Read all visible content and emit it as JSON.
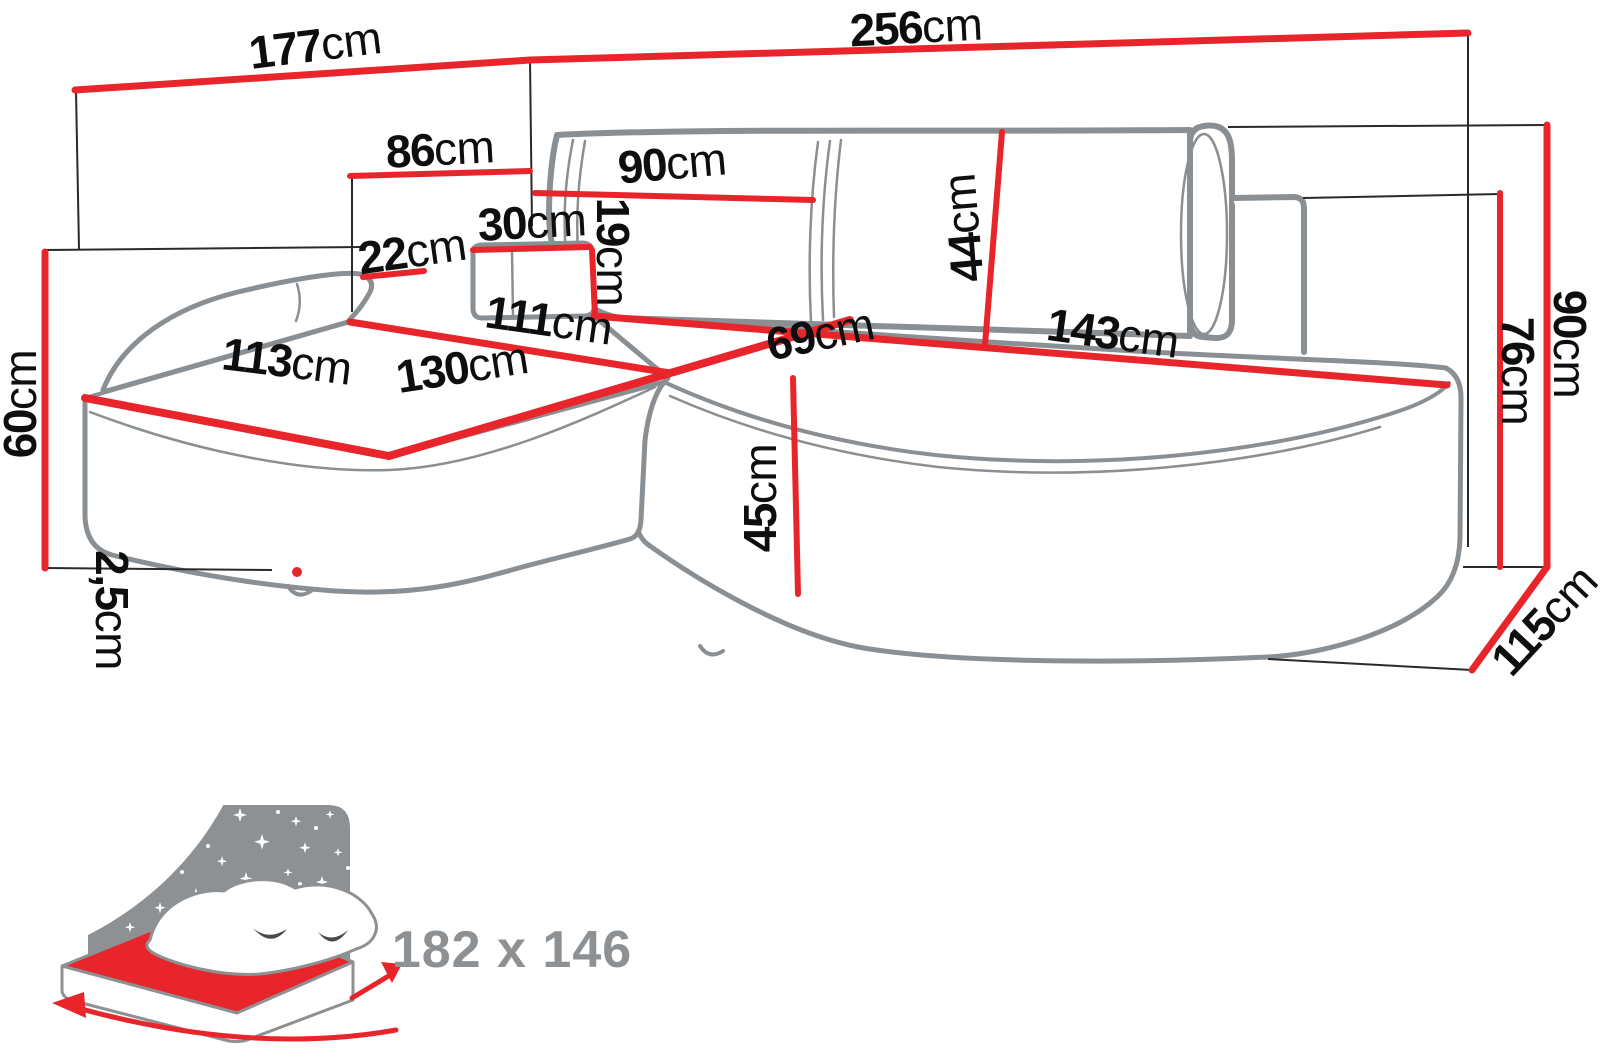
{
  "diagram_type": "corner-sofa-dimension-drawing",
  "unit": "cm",
  "dimensions": {
    "d177": {
      "v": "177",
      "u": "cm"
    },
    "d256": {
      "v": "256",
      "u": "cm"
    },
    "d86": {
      "v": "86",
      "u": "cm"
    },
    "d90top": {
      "v": "90",
      "u": "cm"
    },
    "d30": {
      "v": "30",
      "u": "cm"
    },
    "d19": {
      "v": "19",
      "u": "cm"
    },
    "d22": {
      "v": "22",
      "u": "cm"
    },
    "d44": {
      "v": "44",
      "u": "cm"
    },
    "d111": {
      "v": "111",
      "u": "cm"
    },
    "d113": {
      "v": "113",
      "u": "cm"
    },
    "d130": {
      "v": "130",
      "u": "cm"
    },
    "d69": {
      "v": "69",
      "u": "cm"
    },
    "d143": {
      "v": "143",
      "u": "cm"
    },
    "d60": {
      "v": "60",
      "u": "cm"
    },
    "d2_5": {
      "v": "2,5",
      "u": "cm"
    },
    "d45": {
      "v": "45",
      "u": "cm"
    },
    "d76": {
      "v": "76",
      "u": "cm"
    },
    "d90right": {
      "v": "90",
      "u": "cm"
    },
    "d115": {
      "v": "115",
      "u": "cm"
    }
  },
  "sleeping_area": {
    "size": "182 x 146"
  },
  "icons": {
    "sleeping_function": "bed-with-night-sky-icon"
  },
  "colors": {
    "dimension_red": "#e8252b",
    "sketch_gray": "#8a8f93",
    "label_black": "#0e0e0e",
    "icon_gray": "#8d9194"
  }
}
